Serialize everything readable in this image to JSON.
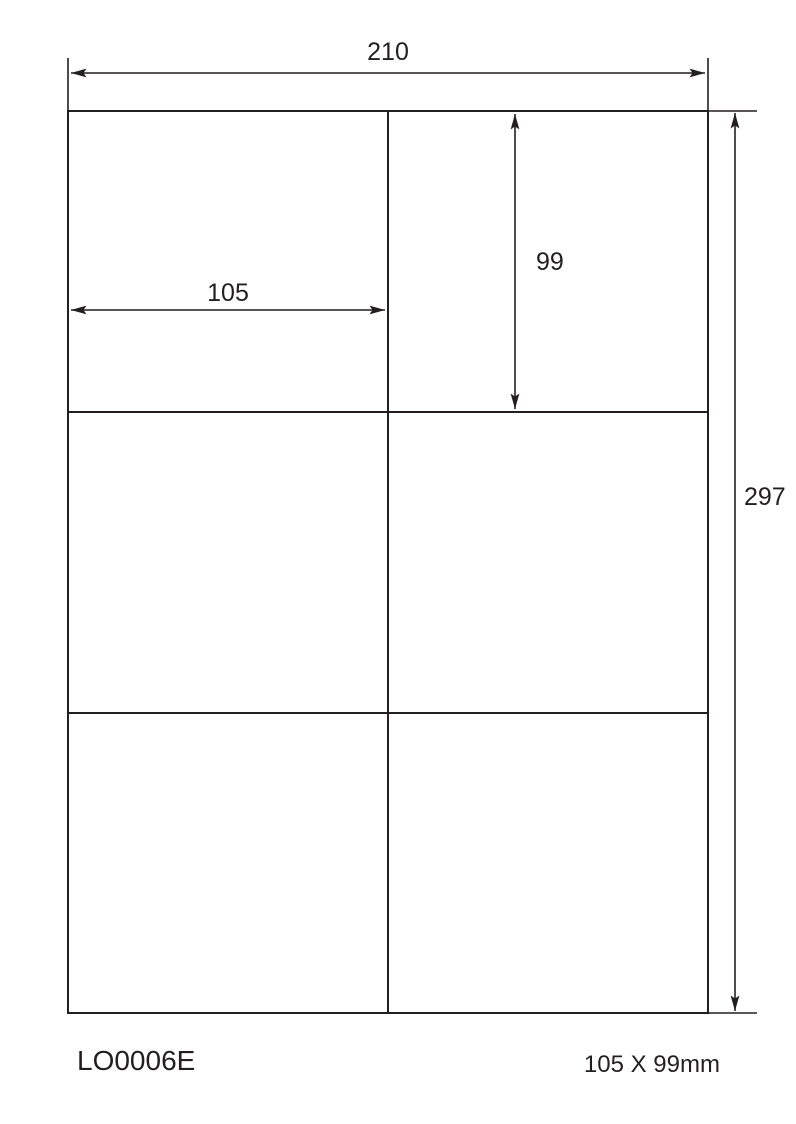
{
  "colors": {
    "ink": "#231f20",
    "background": "#ffffff"
  },
  "sheet": {
    "columns": 2,
    "rows": 3,
    "cell_count": 6
  },
  "dimensions": {
    "sheet_width": "210",
    "sheet_height": "297",
    "label_width": "105",
    "label_height": "99"
  },
  "footer": {
    "product_code": "LO0006E",
    "label_size": "105 X 99mm"
  }
}
